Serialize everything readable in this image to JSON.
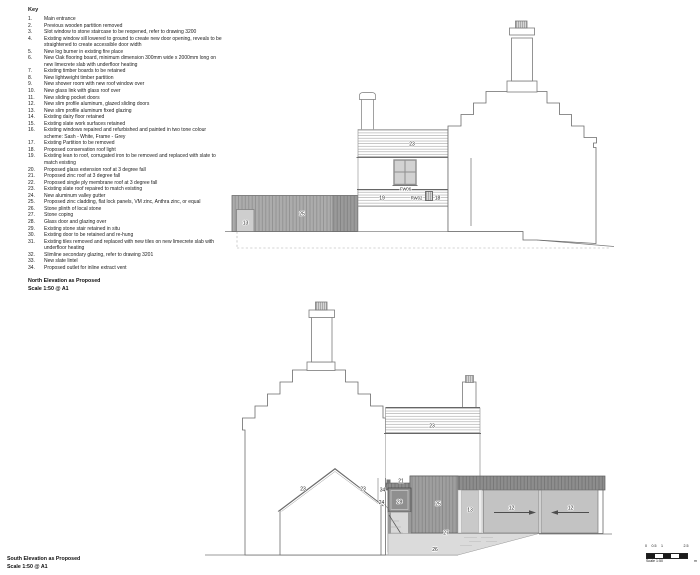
{
  "key": {
    "title": "Key",
    "items": [
      {
        "num": "1.",
        "text": "Main entrance"
      },
      {
        "num": "2.",
        "text": "Previous wooden partition removed"
      },
      {
        "num": "3.",
        "text": "Slot window to stone staircase to be reopened, refer to drawing 3200"
      },
      {
        "num": "4.",
        "text": "Existing window sill lowered to ground to create new door opening, reveals to be straightened to create accessible door width"
      },
      {
        "num": "5.",
        "text": "New log burner in existing fire place"
      },
      {
        "num": "6.",
        "text": "New Oak flooring board, minimum dimension 300mm wide x 2000mm long on new limecrete slab with underfloor heating"
      },
      {
        "num": "7.",
        "text": "Existing timber boards to be retained"
      },
      {
        "num": "8.",
        "text": "New lightweight timber partition"
      },
      {
        "num": "9.",
        "text": "New shower room with new roof window over"
      },
      {
        "num": "10.",
        "text": "New glass link with glass roof over"
      },
      {
        "num": "11.",
        "text": "New sliding pocket doors"
      },
      {
        "num": "12.",
        "text": "New slim profile aluminum, glazed sliding doors"
      },
      {
        "num": "13.",
        "text": "New slim profile aluminum fixed glazing"
      },
      {
        "num": "14.",
        "text": "Existing dairy floor retained"
      },
      {
        "num": "15.",
        "text": "Existing slate work surfaces retained"
      },
      {
        "num": "16.",
        "text": "Existing windows repaired and refurbished and painted in two tone colour scheme: Sash - White, Frame - Grey"
      },
      {
        "num": "17.",
        "text": "Existing Partition to be removed"
      },
      {
        "num": "18.",
        "text": "Proposed conservation roof light"
      },
      {
        "num": "19.",
        "text": "Existing lean to roof, corrugated iron to be removed and replaced with slate to match existing"
      },
      {
        "num": "20.",
        "text": "Proposed glass extension roof at 3 degree fall"
      },
      {
        "num": "21.",
        "text": "Proposed zinc roof at 3 degree fall"
      },
      {
        "num": "22.",
        "text": "Proposed single ply membrane roof at 3 degree fall"
      },
      {
        "num": "23.",
        "text": "Existing slate roof repaired to match existing"
      },
      {
        "num": "24.",
        "text": "New aluminum valley gutter"
      },
      {
        "num": "25.",
        "text": "Proposed zinc cladding, flat lock panels, VM zinc, Anthra zinc, or equal"
      },
      {
        "num": "26.",
        "text": "Stone plinth of local stone"
      },
      {
        "num": "27.",
        "text": "Stone coping"
      },
      {
        "num": "28.",
        "text": "Glass door and glazing over"
      },
      {
        "num": "29.",
        "text": "Existing stone stair retained in situ"
      },
      {
        "num": "30.",
        "text": "Existing door to be retained and re-hung"
      },
      {
        "num": "31.",
        "text": "Existing tiles removed and replaced with new tiles on new limecrete slab with underfloor heating"
      },
      {
        "num": "32.",
        "text": "Slimline secondary glazing, refer to drawing 3201"
      },
      {
        "num": "33.",
        "text": "New slate lintel"
      },
      {
        "num": "34.",
        "text": "Proposed outlet for inline extract vent"
      }
    ]
  },
  "north_elevation": {
    "title": "North Elevation as Proposed",
    "scale": "Scale 1:50 @ A1",
    "labels": {
      "zinc_cladding": "25",
      "fixed_glazing": "13",
      "slate_roof": "23",
      "window_tag": "FW06",
      "lean_to_roof": "19",
      "rainwater_tag": "RW02",
      "rooflight": "18"
    }
  },
  "south_elevation": {
    "title": "South Elevation as Proposed",
    "scale": "Scale 1:50 @ A1",
    "labels": {
      "roof_left_slope": "23",
      "roof_right_slope": "23",
      "main_slate_roof": "23",
      "zinc_roof": "21",
      "extract_vent": "34",
      "valley_gutter": "24",
      "glass_door": "28",
      "zinc_cladding": "25",
      "fixed_glazing": "13",
      "sliding_door_left": "12",
      "sliding_door_right": "12",
      "stone_coping": "27",
      "stone_plinth": "26"
    }
  },
  "scale_bar": {
    "ticks": [
      "0",
      "0.5",
      "1",
      "2.5"
    ],
    "caption": "Scale 1:50",
    "unit": "m"
  },
  "colors": {
    "line": "#6b6b6b",
    "zinc_dark": "#8d8d8d",
    "zinc_mid": "#a2a2a2",
    "panel_light": "#c3c3c3",
    "plinth": "#dbdbdb"
  }
}
